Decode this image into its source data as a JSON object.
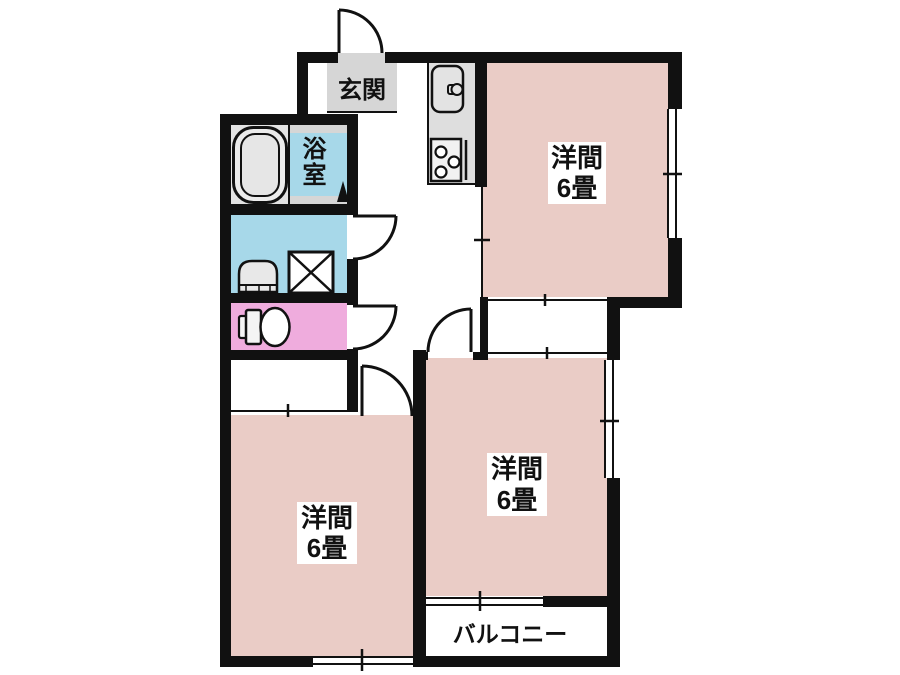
{
  "floor_plan": {
    "entrance": {
      "label": "玄関"
    },
    "bathroom": {
      "label": "浴室"
    },
    "rooms": [
      {
        "id": "top-right",
        "name": "洋間",
        "size": "6畳"
      },
      {
        "id": "middle-right",
        "name": "洋間",
        "size": "6畳"
      },
      {
        "id": "bottom-left",
        "name": "洋間",
        "size": "6畳"
      }
    ],
    "balcony": {
      "label": "バルコニー"
    },
    "fixtures": [
      "bathtub",
      "kitchen-sink",
      "gas-stove",
      "washbasin",
      "washing-machine-pan",
      "toilet"
    ]
  },
  "colors": {
    "room_fill": "#eaccc6",
    "wet_fill": "#a7d8e9",
    "toilet_fill": "#efacdd",
    "gray_fill": "#d6d6d6",
    "wall": "#111111"
  }
}
